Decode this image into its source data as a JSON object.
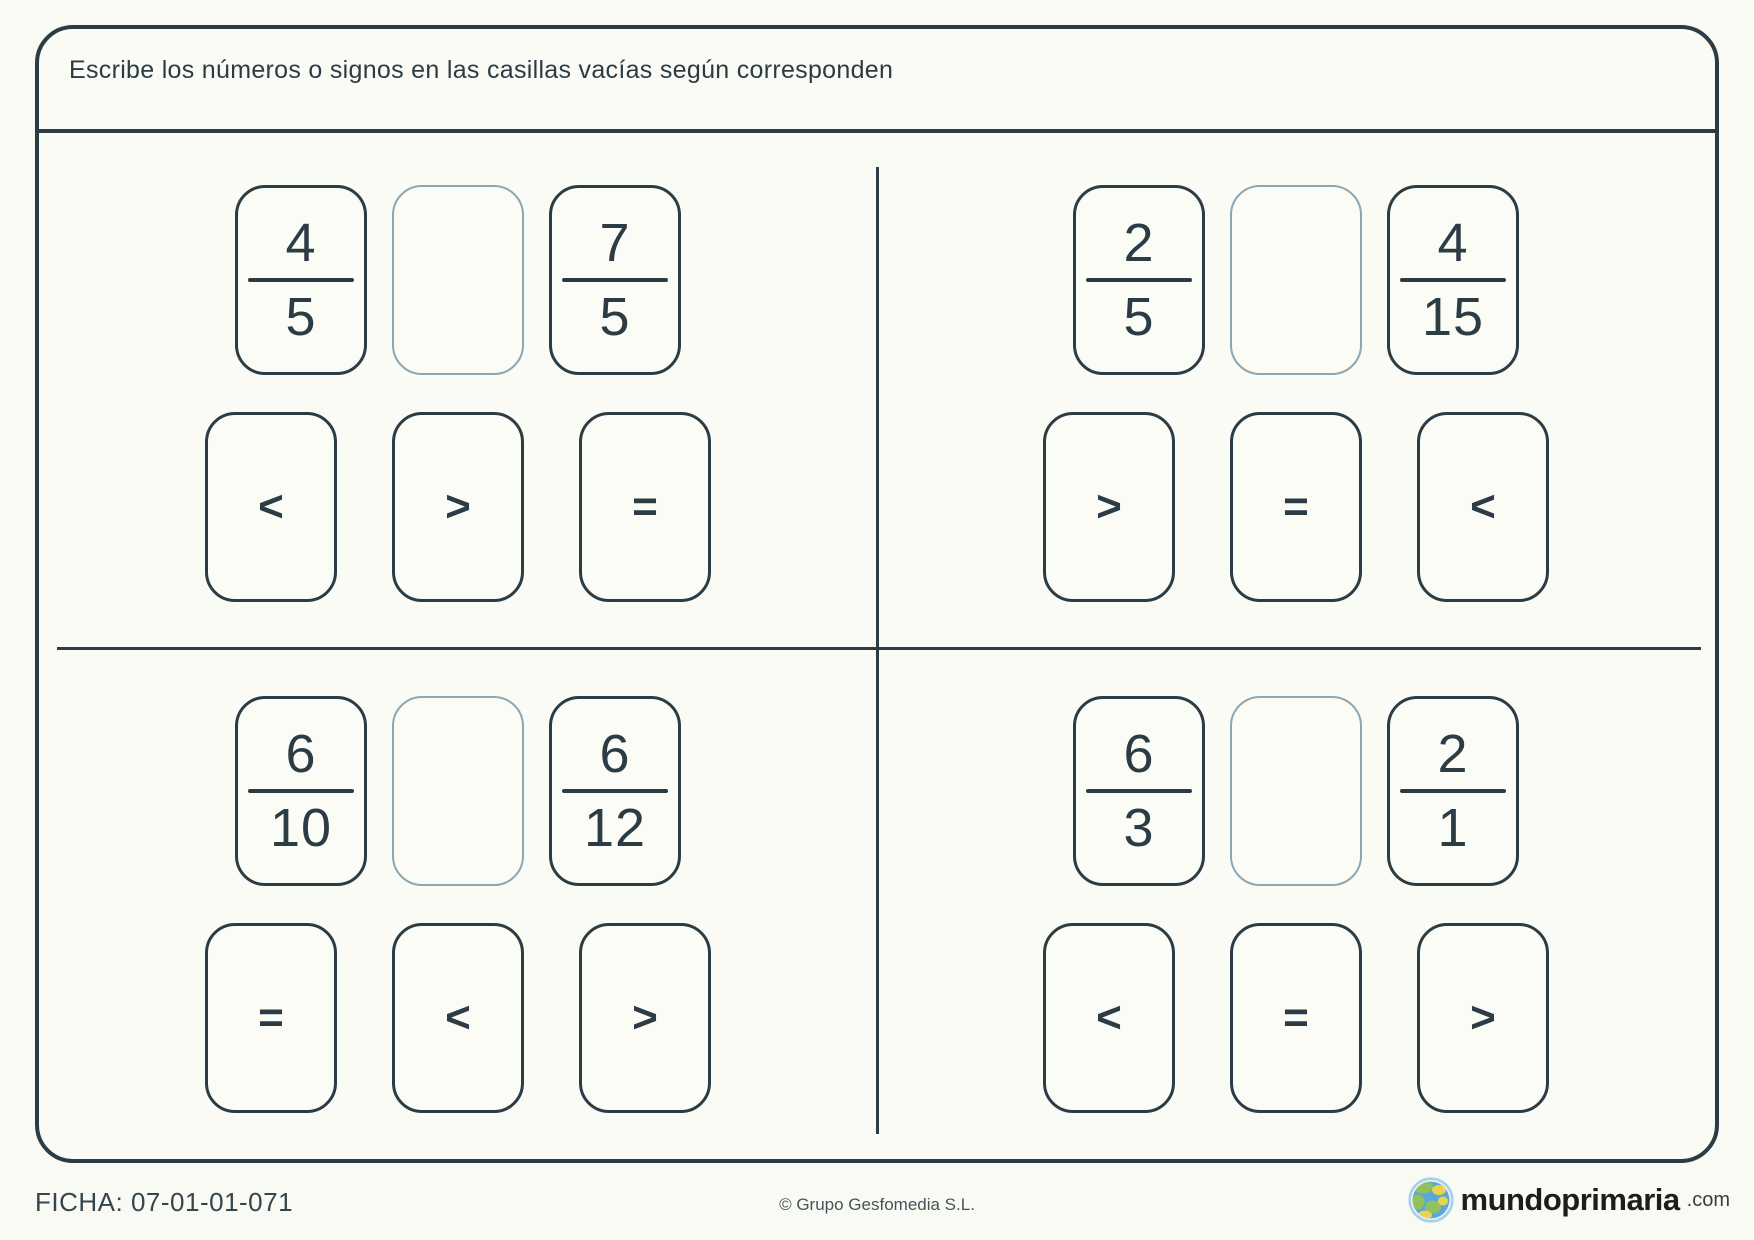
{
  "header": {
    "instruction": "Escribe los números o signos en las casillas vacías según corresponden"
  },
  "exercises": [
    {
      "left": {
        "numerator": "4",
        "denominator": "5"
      },
      "right": {
        "numerator": "7",
        "denominator": "5"
      },
      "options": [
        "<",
        ">",
        "="
      ]
    },
    {
      "left": {
        "numerator": "2",
        "denominator": "5"
      },
      "right": {
        "numerator": "4",
        "denominator": "15"
      },
      "options": [
        ">",
        "=",
        "<"
      ]
    },
    {
      "left": {
        "numerator": "6",
        "denominator": "10"
      },
      "right": {
        "numerator": "6",
        "denominator": "12"
      },
      "options": [
        "=",
        "<",
        ">"
      ]
    },
    {
      "left": {
        "numerator": "6",
        "denominator": "3"
      },
      "right": {
        "numerator": "2",
        "denominator": "1"
      },
      "options": [
        "<",
        "=",
        ">"
      ]
    }
  ],
  "footer": {
    "ficha": "FICHA: 07-01-01-071",
    "copyright": "© Grupo Gesfomedia S.L.",
    "logo": {
      "name": "mundoprimaria",
      "tld": ".com",
      "icon": "globe-icon"
    }
  },
  "colors": {
    "ink": "#2c3c44",
    "empty_box_border": "#8ca6b2",
    "background": "#fafaf4",
    "logo_globe_blue": "#5aa8d8",
    "logo_globe_green": "#93c05e",
    "logo_globe_yellow": "#e8d44d"
  }
}
